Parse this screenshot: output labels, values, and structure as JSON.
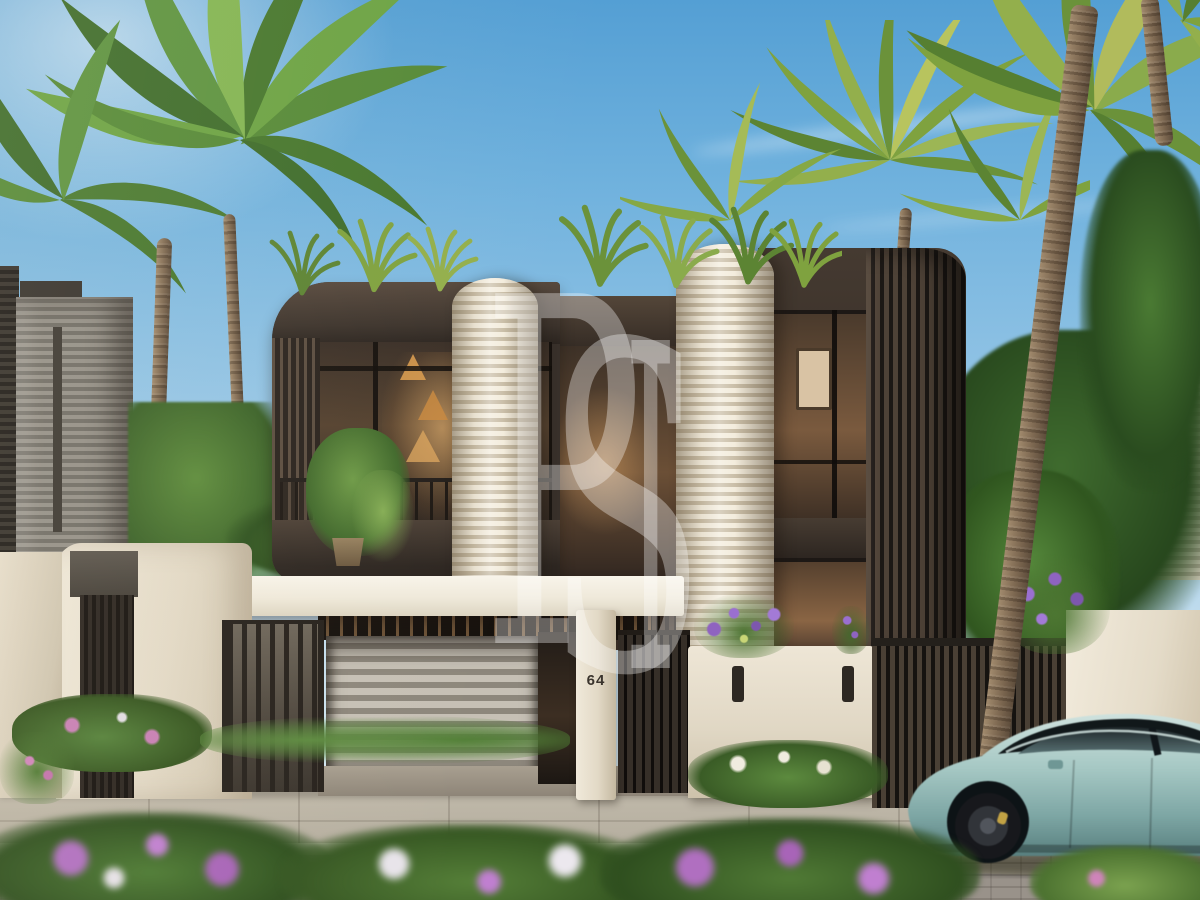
{
  "scene": {
    "type": "3D architectural exterior rendering",
    "description": "Modern two-storey luxury villa with dark bronze facade, ribbed cream cylindrical towers, white entrance canopy, gated driveway, tropical palms and a teal sports car passing in front"
  },
  "watermark": {
    "letter_1": "P",
    "letter_2": "S",
    "letter_3": "I"
  },
  "signage": {
    "house_number": "64"
  },
  "palette": {
    "sky_top": "#549fd4",
    "sky_horizon": "#e3eff4",
    "facade_bronze": "#38302a",
    "facade_cream_rib": "#ece3d2",
    "canopy_white": "#f6f2e8",
    "window_glow": "#b98e62",
    "foliage_green": "#4e7d36",
    "sidewalk_grey": "#b5ae9f",
    "street_grey": "#99928a",
    "car_teal": "#9fc3bf",
    "flower_purple": "#9b6ec1"
  }
}
